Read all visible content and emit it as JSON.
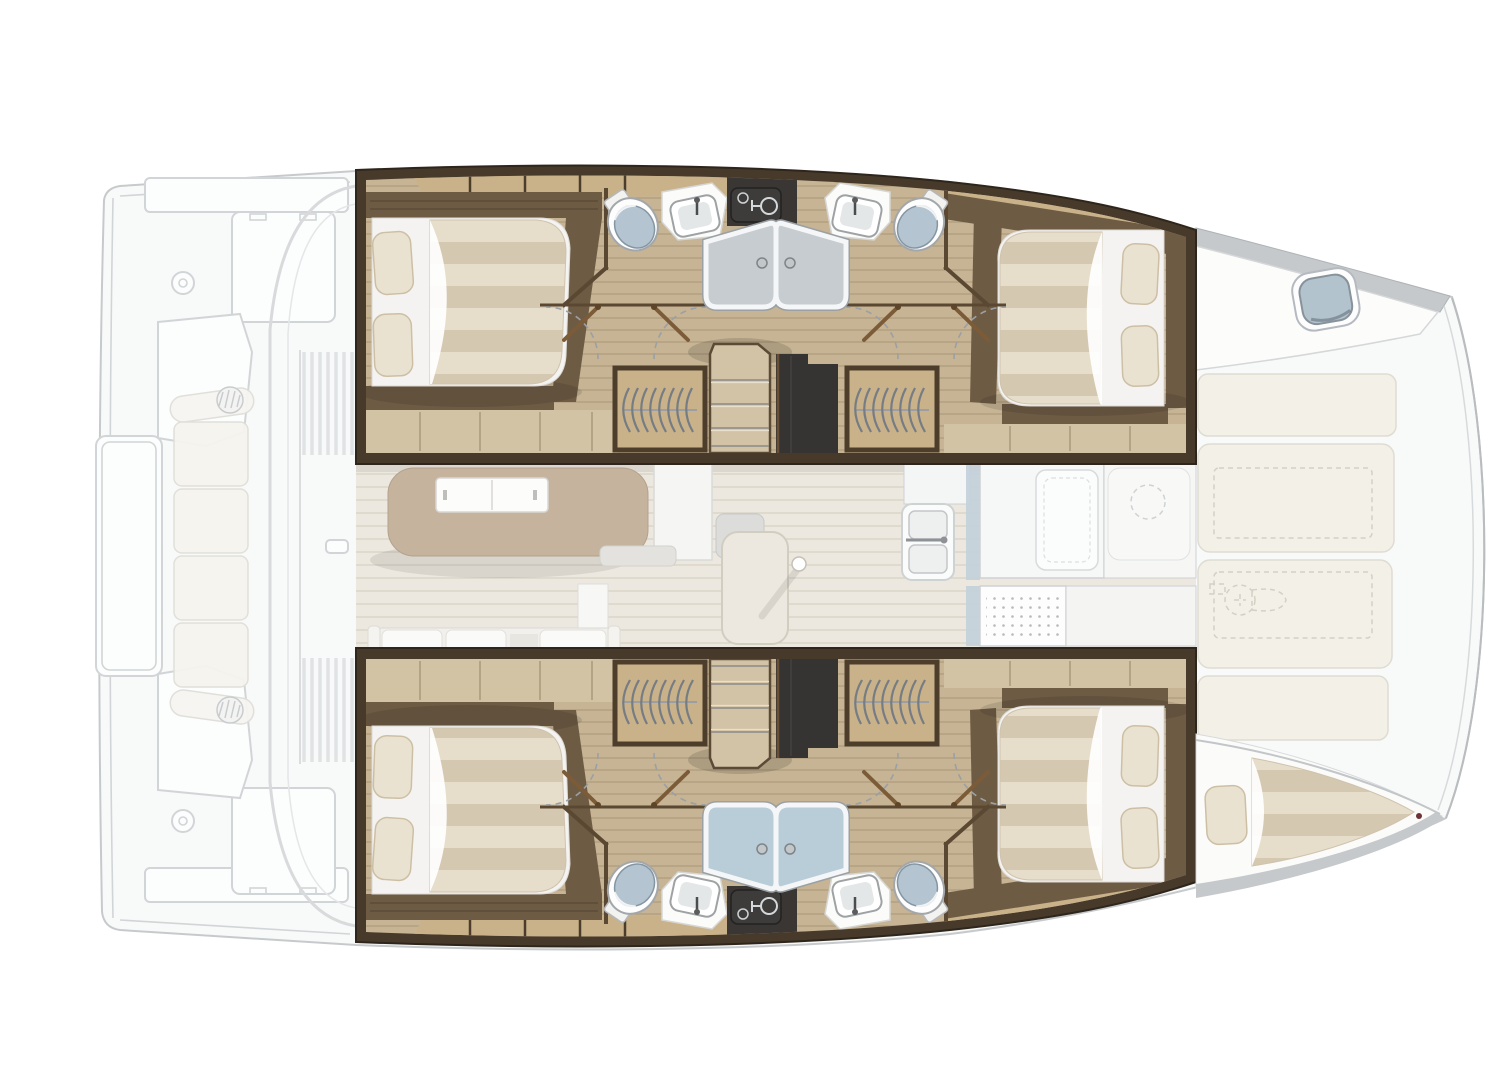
{
  "meta": {
    "title": "Catamaran interior layout — top-down floor plan",
    "type": "boat-floor-plan",
    "orientation": "bow to the right, stern to the left"
  },
  "palette": {
    "hull_line": "#c7cacc",
    "hull_fill": "#f8f9f9",
    "faded_stroke": "#d2d5d7",
    "frame_dark": "#473a2b",
    "frame_edge": "#2e261c",
    "floor_tan": "#c6b494",
    "locker_wood": "#c9b289",
    "walnut": "#6e5b44",
    "light_wood": "#d2c3a5",
    "charcoal": "#363432",
    "console_dark": "#3d3c3b",
    "bed_sheet": "#f4f3f1",
    "duvet_a": "#e7ddcb",
    "duvet_b": "#d5c8b1",
    "pillow": "#eae2d0",
    "pillow_edge": "#cdbfa4",
    "shower_gray": "#c7ccd0",
    "shower_blue": "#b9cdd9",
    "fixture_white": "#fbfbfa",
    "lid_blue": "#b4c4d0",
    "salon_floor": "#ece8df",
    "table_wood": "#c5b39d",
    "galley_white": "#f6f7f7",
    "galley_line": "#ced1d3",
    "accent_blue": "#c3d0da",
    "deck_cream": "#f3f0e8",
    "deck_cream_line": "#dfdcd2",
    "dash_line": "#d3d0c5",
    "gunwale": "#c5c9cc",
    "hatch_blue": "#b3c3ce",
    "arc_dash": "#9aa0a5",
    "door_brown": "#7c5c38",
    "wall_brown": "#5a4832"
  },
  "vessel": {
    "layout": "4 double cabins, 4 ensuite shower rooms, central salon with galley, aft cockpit, foredeck with lockers and windlass",
    "sections": {
      "aft_cockpit": {
        "label": "Aft cockpit",
        "features": [
          "bench seating",
          "cockpit table",
          "engine hatches",
          "helm seats",
          "sliding door",
          "transom platforms"
        ]
      },
      "salon": {
        "label": "Salon",
        "features": [
          "dinette table",
          "sideboard",
          "sofa",
          "floor hatch"
        ]
      },
      "galley": {
        "label": "Galley",
        "features": [
          "double sink",
          "refrigerator",
          "stove",
          "worktops"
        ]
      },
      "port_hull": {
        "label": "Port hull",
        "aft_cabin": {
          "label": "Port aft double cabin"
        },
        "fwd_cabin": {
          "label": "Port forward double cabin"
        },
        "bathrooms": {
          "label": "Two ensuite shower rooms",
          "fixtures": [
            "toilet",
            "washbasin",
            "shower",
            "wardrobe"
          ]
        },
        "stairs": {
          "label": "Companionway steps"
        }
      },
      "starboard_hull": {
        "label": "Starboard hull",
        "aft_cabin": {
          "label": "Starboard aft double cabin"
        },
        "fwd_cabin": {
          "label": "Starboard forward double cabin"
        },
        "bathrooms": {
          "label": "Two ensuite shower rooms",
          "fixtures": [
            "toilet",
            "washbasin",
            "shower",
            "wardrobe"
          ]
        },
        "stairs": {
          "label": "Companionway steps"
        }
      },
      "foredeck": {
        "label": "Foredeck",
        "features": [
          "deck lockers",
          "windlass",
          "bow panels"
        ]
      },
      "port_bow": {
        "label": "Port bow",
        "features": [
          "deck hatch"
        ]
      },
      "starboard_bow": {
        "label": "Starboard bow",
        "features": [
          "forepeak berth"
        ]
      }
    },
    "counts": {
      "double_beds": 4,
      "single_berths": 1,
      "toilets": 4,
      "washbasins": 4,
      "showers": 4,
      "wardrobes": 4,
      "deck_hatches": 1,
      "windlasses": 1
    }
  }
}
